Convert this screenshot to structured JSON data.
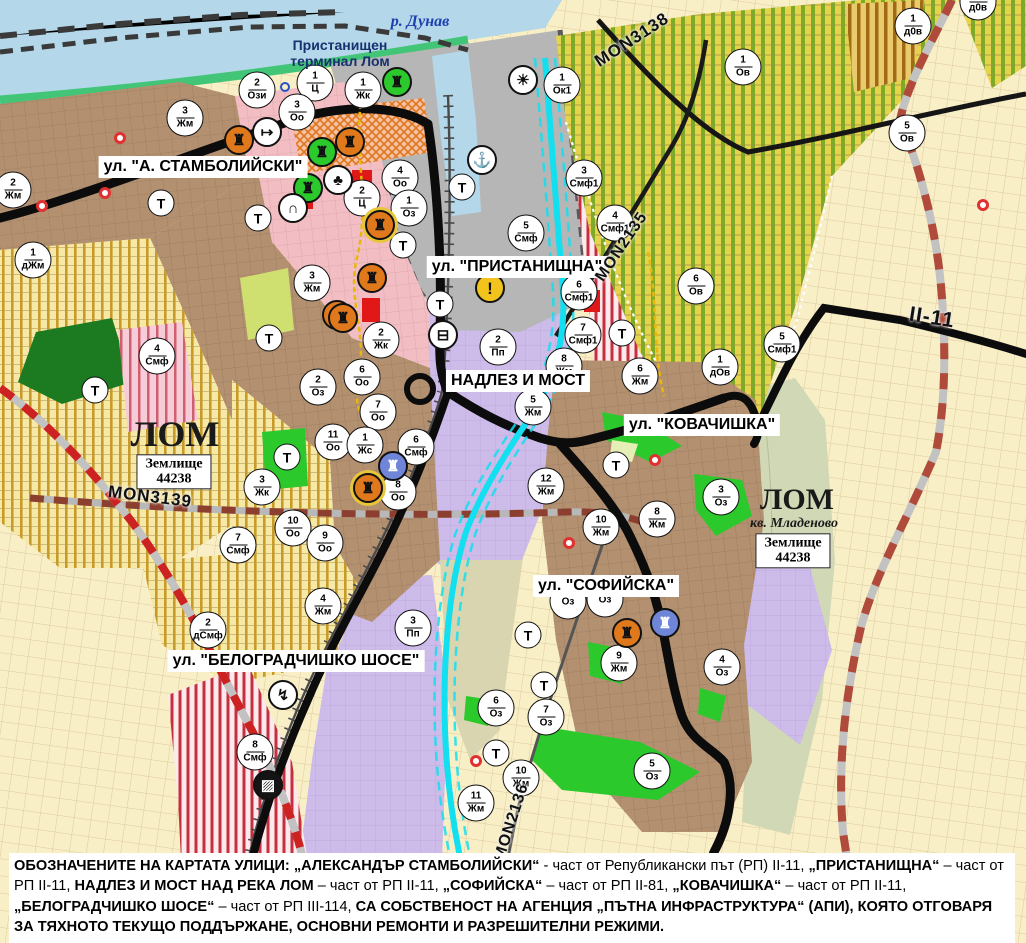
{
  "map": {
    "water_label": {
      "text": "р. Дунав",
      "x": 420,
      "y": 22
    },
    "terminal_label": {
      "text": "Пристанищен\nтерминал Лом",
      "x": 340,
      "y": 53
    },
    "street_labels": [
      {
        "text": "ул. \"А. СТАМБОЛИЙСКИ\"",
        "x": 203,
        "y": 167
      },
      {
        "text": "ул. \"ПРИСТАНИЩНА\"",
        "x": 517,
        "y": 267
      },
      {
        "text": "НАДЛЕЗ И МОСТ",
        "x": 518,
        "y": 381
      },
      {
        "text": "ул. \"КОВАЧИШКА\"",
        "x": 702,
        "y": 425
      },
      {
        "text": "ул. \"СОФИЙСКА\"",
        "x": 606,
        "y": 586
      },
      {
        "text": "ул. \"БЕЛОГРАДЧИШКО ШОСЕ\"",
        "x": 296,
        "y": 661
      }
    ],
    "place_labels": [
      {
        "text": "ЛОМ",
        "x": 175,
        "y": 434,
        "size": 36
      },
      {
        "text": "ЛОМ",
        "x": 797,
        "y": 500,
        "size": 30
      },
      {
        "text": "кв. Младеново",
        "x": 794,
        "y": 524,
        "size": 14,
        "italic": true
      }
    ],
    "plot_labels": [
      {
        "text": "Землище\n44238",
        "x": 174,
        "y": 472
      },
      {
        "text": "Землище\n44238",
        "x": 793,
        "y": 551
      }
    ],
    "road_labels": [
      {
        "text": "MON3138",
        "x": 632,
        "y": 40,
        "rot": -33,
        "size": 17
      },
      {
        "text": "MON2135",
        "x": 622,
        "y": 247,
        "rot": -56,
        "size": 16
      },
      {
        "text": "MON3139",
        "x": 150,
        "y": 497,
        "rot": 7,
        "size": 17
      },
      {
        "text": "MON2136",
        "x": 512,
        "y": 822,
        "rot": -72,
        "size": 16
      },
      {
        "text": "II-11",
        "x": 932,
        "y": 318,
        "rot": 9,
        "size": 21
      }
    ],
    "zone_markers": [
      {
        "n": "2",
        "c": "Ози",
        "x": 257,
        "y": 90
      },
      {
        "n": "1",
        "c": "Ц",
        "x": 315,
        "y": 83
      },
      {
        "n": "3",
        "c": "Жм",
        "x": 185,
        "y": 118
      },
      {
        "n": "3",
        "c": "Оо",
        "x": 297,
        "y": 112
      },
      {
        "n": "2",
        "c": "Жм",
        "x": 13,
        "y": 190
      },
      {
        "n": "1",
        "c": "дЖм",
        "x": 33,
        "y": 260
      },
      {
        "n": "3",
        "c": "Жм",
        "x": 312,
        "y": 283
      },
      {
        "n": "1",
        "c": "Жк",
        "x": 363,
        "y": 90
      },
      {
        "n": "4",
        "c": "Оо",
        "x": 400,
        "y": 178
      },
      {
        "n": "2",
        "c": "Ц",
        "x": 362,
        "y": 198
      },
      {
        "n": "1",
        "c": "Оз",
        "x": 409,
        "y": 208
      },
      {
        "n": "1",
        "c": "Ок1",
        "x": 562,
        "y": 85
      },
      {
        "n": "3",
        "c": "Смф1",
        "x": 584,
        "y": 178
      },
      {
        "n": "4",
        "c": "Смф1",
        "x": 615,
        "y": 223
      },
      {
        "n": "5",
        "c": "Смф",
        "x": 526,
        "y": 233
      },
      {
        "n": "6",
        "c": "Смф1",
        "x": 579,
        "y": 292
      },
      {
        "n": "1",
        "c": "д0в",
        "x": 913,
        "y": 26
      },
      {
        "n": "1",
        "c": "д0в",
        "x": 978,
        "y": 2
      },
      {
        "n": "1",
        "c": "Ов",
        "x": 743,
        "y": 67
      },
      {
        "n": "5",
        "c": "Ов",
        "x": 907,
        "y": 133
      },
      {
        "n": "6",
        "c": "Ов",
        "x": 696,
        "y": 286
      },
      {
        "n": "5",
        "c": "Смф1",
        "x": 782,
        "y": 344
      },
      {
        "n": "1",
        "c": "дОв",
        "x": 720,
        "y": 367
      },
      {
        "n": "2",
        "c": "Жк",
        "x": 381,
        "y": 340
      },
      {
        "n": "6",
        "c": "Оо",
        "x": 362,
        "y": 377
      },
      {
        "n": "7",
        "c": "Оо",
        "x": 378,
        "y": 412
      },
      {
        "n": "11",
        "c": "Оо",
        "x": 333,
        "y": 442
      },
      {
        "n": "1",
        "c": "Жс",
        "x": 365,
        "y": 445
      },
      {
        "n": "6",
        "c": "Смф",
        "x": 416,
        "y": 447
      },
      {
        "n": "8",
        "c": "Оо",
        "x": 398,
        "y": 492
      },
      {
        "n": "2",
        "c": "Пп",
        "x": 498,
        "y": 347
      },
      {
        "n": "7",
        "c": "Смф1",
        "x": 583,
        "y": 335
      },
      {
        "n": "8",
        "c": "Жм",
        "x": 564,
        "y": 366
      },
      {
        "n": "5",
        "c": "Жм",
        "x": 533,
        "y": 407
      },
      {
        "n": "12",
        "c": "Жм",
        "x": 546,
        "y": 486
      },
      {
        "n": "6",
        "c": "Жм",
        "x": 640,
        "y": 376
      },
      {
        "n": "10",
        "c": "Жм",
        "x": 601,
        "y": 527
      },
      {
        "n": "4",
        "c": "Смф",
        "x": 157,
        "y": 356
      },
      {
        "n": "2",
        "c": "Оз",
        "x": 318,
        "y": 387
      },
      {
        "n": "3",
        "c": "Жк",
        "x": 262,
        "y": 487
      },
      {
        "n": "10",
        "c": "Оо",
        "x": 293,
        "y": 528
      },
      {
        "n": "9",
        "c": "Оо",
        "x": 325,
        "y": 543
      },
      {
        "n": "7",
        "c": "Смф",
        "x": 238,
        "y": 545
      },
      {
        "n": "8",
        "c": "Жм",
        "x": 657,
        "y": 519
      },
      {
        "n": "3",
        "c": "Оз",
        "x": 721,
        "y": 497
      },
      {
        "n": "",
        "c": "Оз",
        "x": 568,
        "y": 601
      },
      {
        "n": "",
        "c": "Оз",
        "x": 605,
        "y": 599
      },
      {
        "n": "9",
        "c": "Жм",
        "x": 619,
        "y": 663
      },
      {
        "n": "4",
        "c": "Оз",
        "x": 722,
        "y": 667
      },
      {
        "n": "6",
        "c": "Оз",
        "x": 496,
        "y": 708
      },
      {
        "n": "7",
        "c": "Оз",
        "x": 546,
        "y": 717
      },
      {
        "n": "10",
        "c": "Жм",
        "x": 521,
        "y": 778
      },
      {
        "n": "11",
        "c": "Жм",
        "x": 476,
        "y": 803
      },
      {
        "n": "5",
        "c": "Оз",
        "x": 652,
        "y": 771
      },
      {
        "n": "2",
        "c": "дСмф",
        "x": 208,
        "y": 630
      },
      {
        "n": "4",
        "c": "Жм",
        "x": 323,
        "y": 606
      },
      {
        "n": "3",
        "c": "Пп",
        "x": 413,
        "y": 628
      },
      {
        "n": "8",
        "c": "Смф",
        "x": 255,
        "y": 752
      }
    ],
    "t_markers": [
      {
        "x": 161,
        "y": 203
      },
      {
        "x": 258,
        "y": 218
      },
      {
        "x": 462,
        "y": 187
      },
      {
        "x": 403,
        "y": 245
      },
      {
        "x": 440,
        "y": 304
      },
      {
        "x": 269,
        "y": 338
      },
      {
        "x": 95,
        "y": 390
      },
      {
        "x": 287,
        "y": 457
      },
      {
        "x": 622,
        "y": 333
      },
      {
        "x": 616,
        "y": 465
      },
      {
        "x": 528,
        "y": 635
      },
      {
        "x": 544,
        "y": 685
      },
      {
        "x": 496,
        "y": 753
      }
    ],
    "icon_markers": [
      {
        "name": "monument-icon",
        "cls": "orange",
        "g": "♜",
        "x": 239,
        "y": 140
      },
      {
        "name": "key-route-icon",
        "cls": "white",
        "g": "↦",
        "x": 267,
        "y": 132
      },
      {
        "name": "monument-icon",
        "cls": "green",
        "g": "♜",
        "x": 322,
        "y": 152
      },
      {
        "name": "monument-icon",
        "cls": "orange",
        "g": "♜",
        "x": 350,
        "y": 142
      },
      {
        "name": "monument-icon",
        "cls": "green",
        "g": "♜",
        "x": 308,
        "y": 188
      },
      {
        "name": "park-icon",
        "cls": "white",
        "g": "♣",
        "x": 338,
        "y": 180
      },
      {
        "name": "tunnel-icon",
        "cls": "white",
        "g": "∩",
        "x": 293,
        "y": 208
      },
      {
        "name": "monument-icon",
        "cls": "orangering",
        "g": "♜",
        "x": 380,
        "y": 225
      },
      {
        "name": "monument-icon",
        "cls": "green",
        "g": "♜",
        "x": 397,
        "y": 82
      },
      {
        "name": "sun-icon",
        "cls": "white",
        "g": "☀",
        "x": 523,
        "y": 80
      },
      {
        "name": "anchor-port-icon",
        "cls": "white",
        "g": "⚓",
        "x": 482,
        "y": 160
      },
      {
        "name": "truck-station-icon",
        "cls": "white",
        "g": "⊟",
        "x": 443,
        "y": 335
      },
      {
        "name": "warning-icon",
        "cls": "yellow",
        "g": "!",
        "x": 490,
        "y": 288
      },
      {
        "name": "monument-icon",
        "cls": "orange",
        "g": "♜",
        "x": 337,
        "y": 315
      },
      {
        "name": "monument-icon",
        "cls": "orange",
        "g": "♜",
        "x": 372,
        "y": 278
      },
      {
        "name": "monument-icon",
        "cls": "orange",
        "g": "♜",
        "x": 343,
        "y": 318
      },
      {
        "name": "monument-icon",
        "cls": "blue",
        "g": "♜",
        "x": 393,
        "y": 466
      },
      {
        "name": "monument-icon",
        "cls": "orangering",
        "g": "♜",
        "x": 368,
        "y": 488
      },
      {
        "name": "monument-icon",
        "cls": "orange",
        "g": "♜",
        "x": 627,
        "y": 633
      },
      {
        "name": "monument-icon",
        "cls": "blue",
        "g": "♜",
        "x": 665,
        "y": 623
      },
      {
        "name": "power-icon",
        "cls": "white",
        "g": "↯",
        "x": 283,
        "y": 695
      },
      {
        "name": "railway-crossing-icon",
        "cls": "black",
        "g": "▨",
        "x": 268,
        "y": 785
      }
    ],
    "dots": [
      {
        "cls": "red",
        "x": 120,
        "y": 138
      },
      {
        "cls": "red",
        "x": 42,
        "y": 206
      },
      {
        "cls": "red",
        "x": 105,
        "y": 193
      },
      {
        "cls": "red",
        "x": 569,
        "y": 543
      },
      {
        "cls": "red",
        "x": 655,
        "y": 460
      },
      {
        "cls": "red",
        "x": 476,
        "y": 761
      },
      {
        "cls": "red",
        "x": 983,
        "y": 205
      },
      {
        "cls": "blue",
        "x": 285,
        "y": 87
      }
    ]
  },
  "caption": {
    "segments": [
      {
        "b": true,
        "t": "ОБОЗНАЧЕНИТЕ НА КАРТАТА УЛИЦИ: „АЛЕКСАНДЪР СТАМБОЛИЙСКИ“"
      },
      {
        "b": false,
        "t": " - част от Републикански път (РП) II-11, "
      },
      {
        "b": true,
        "t": "„ПРИСТАНИЩНА“"
      },
      {
        "b": false,
        "t": " – част от РП II-11, "
      },
      {
        "b": true,
        "t": "НАДЛЕЗ И МОСТ НАД РЕКА ЛОМ"
      },
      {
        "b": false,
        "t": " – част от РП II-11, "
      },
      {
        "b": true,
        "t": "„СОФИЙСКА“"
      },
      {
        "b": false,
        "t": " – част от РП II-81, "
      },
      {
        "b": true,
        "t": "„КОВАЧИШКА“"
      },
      {
        "b": false,
        "t": " – част от РП II-11, "
      },
      {
        "b": true,
        "t": "„БЕЛОГРАДЧИШКО ШОСЕ“"
      },
      {
        "b": false,
        "t": " – част от РП III-114, "
      },
      {
        "b": true,
        "t": "СА СОБСТВЕНОСТ НА АГЕНЦИЯ „ПЪТНА ИНФРАСТРУКТУРА“ (АПИ), КОЯТО ОТГОВАРЯ ЗА ТЯХНОТО ТЕКУЩО ПОДДЪРЖАНЕ, ОСНОВНИ РЕМОНТИ И РАЗРЕШИТЕЛНИ РЕЖИМИ."
      }
    ]
  },
  "colors": {
    "water": "#b4d7e9",
    "river_lom": "#12dff0",
    "urban_brown": "#b29070",
    "zone_pink": "#f3bdc4",
    "zone_purple": "#cdbbe9",
    "cadastre_cream": "#f9efc6",
    "orchard_olive_stripe": "#7cab27",
    "vineyard_yellow_stripe": "#c89a28",
    "mixed_red_stripe": "#c53040",
    "green_area": "#2cc92c",
    "road_black": "#0c0c0c",
    "road_repair_red": "#cc2222",
    "terminal_gray": "#b6b6b6"
  }
}
